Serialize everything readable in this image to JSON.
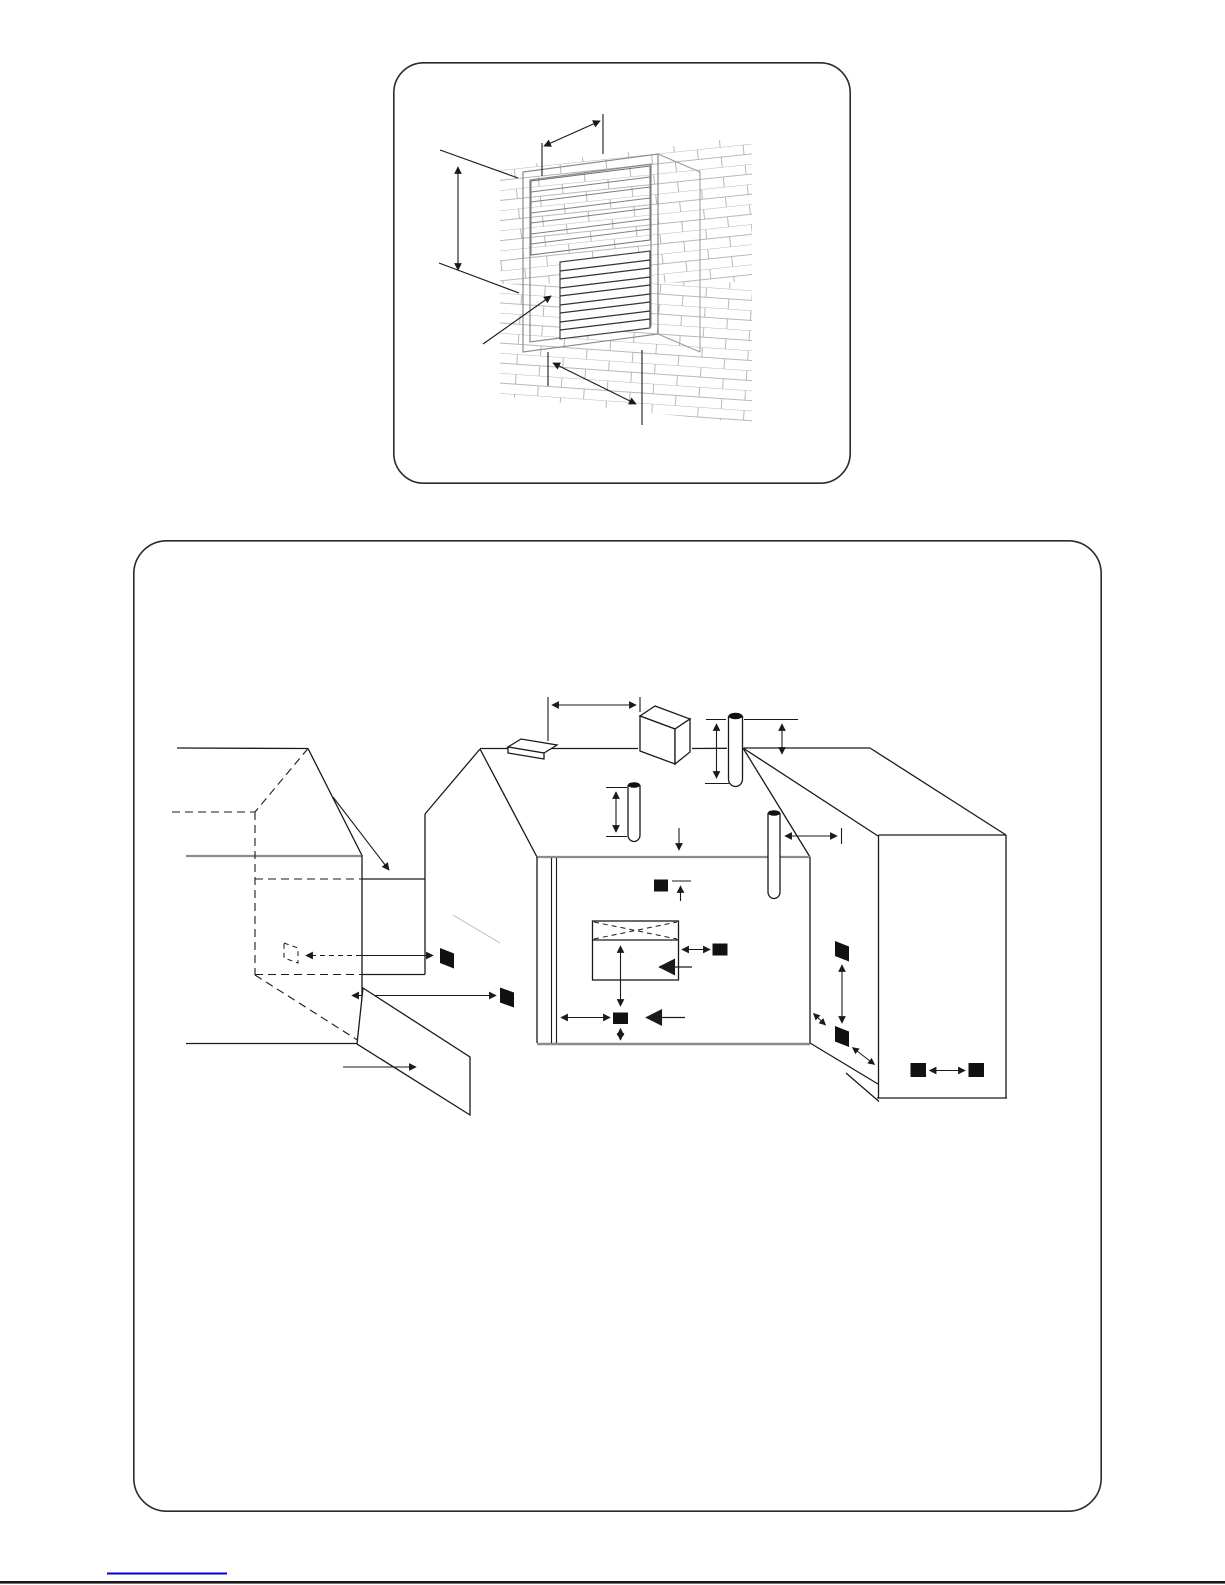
{
  "page": {
    "background_color": "#ffffff"
  },
  "colors": {
    "ink": "#1a1a1a",
    "terminal_fill": "#111111",
    "wall_gray": "#8c8c8c",
    "frame_gray": "#8a8a8a",
    "slat_gray": "#777777",
    "brick_line": "#b8b8b8",
    "light_leader": "#bbbbbb",
    "link_blue": "#0000cc",
    "panel_border": "#2b2b2b"
  },
  "figure1": {
    "name": "flue-terminal-wall-grille-detail",
    "has_brick_wall": true,
    "louvre_blocks": 2
  },
  "figure2": {
    "name": "flue-terminal-positions-house",
    "black_terminal_count": 9,
    "dashed_terminal_count": 1,
    "roof_pipe_count": 3,
    "has_chimney": true,
    "has_window": true,
    "has_fence": true
  },
  "footer": {
    "link_rule": true
  }
}
